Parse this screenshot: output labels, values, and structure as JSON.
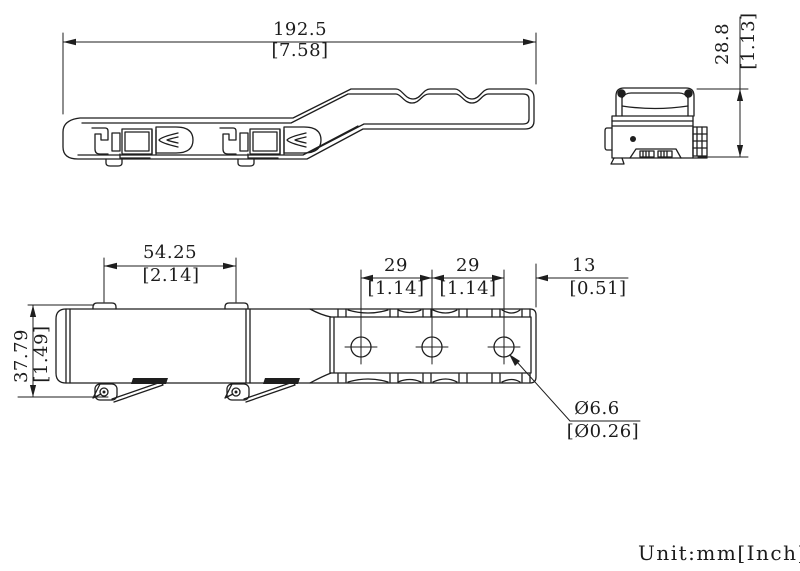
{
  "dimensions": {
    "overall_length": {
      "mm": "192.5",
      "inch": "[7.58]"
    },
    "overall_height": {
      "mm": "28.8",
      "inch": "[1.13]"
    },
    "tab_spacing": {
      "mm": "54.25",
      "inch": "[2.14]"
    },
    "hole_pitch_1": {
      "mm": "29",
      "inch": "[1.14]"
    },
    "hole_pitch_2": {
      "mm": "29",
      "inch": "[1.14]"
    },
    "end_offset": {
      "mm": "13",
      "inch": "[0.51]"
    },
    "overall_width": {
      "mm": "37.79",
      "inch": "[1.49]"
    },
    "hole_diameter": {
      "mm": "Ø6.6",
      "inch": "[Ø0.26]"
    }
  },
  "footer": {
    "unit_label": "Unit:mm[Inch]"
  },
  "style": {
    "line_color": "#1e1e1e",
    "background": "#ffffff"
  }
}
